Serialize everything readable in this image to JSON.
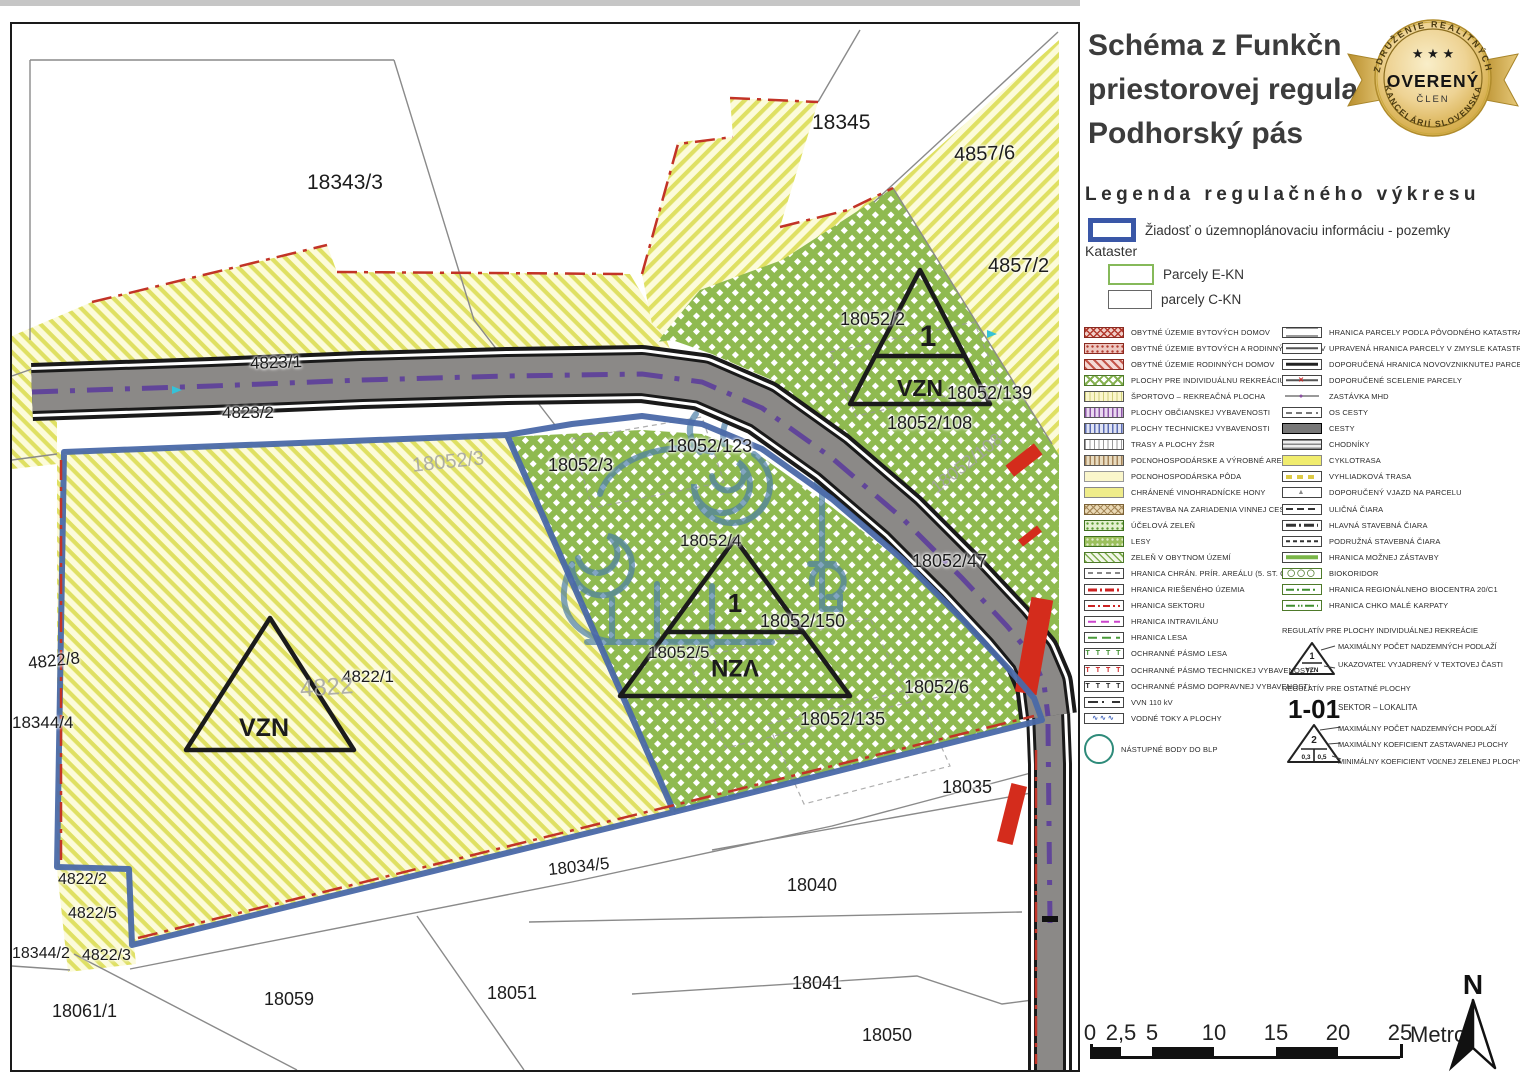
{
  "title": {
    "line1": "Schéma z Funkčn",
    "line2": "priestorovej regula",
    "line3": "Podhorský pás"
  },
  "badge": {
    "arc_top": "ZDRUŽENIE REALITNÝCH",
    "arc_bottom": "KANCELÁRIÍ SLOVENSKA",
    "stars": "★ ★ ★",
    "main": "OVERENÝ",
    "sub": "ČLEN"
  },
  "legend": {
    "heading": "Legenda regulačného výkresu",
    "request": {
      "label": "Žiadosť o územnoplánovaciu informáciu - pozemky"
    },
    "kataster_heading": "Kataster",
    "kataster_items": [
      {
        "label": "Parcely E-KN"
      },
      {
        "label": "parcely C-KN"
      }
    ],
    "left_items": [
      {
        "label": "OBYTNÉ ÚZEMIE BYTOVÝCH DOMOV",
        "sw": "sw-red-cross"
      },
      {
        "label": "OBYTNÉ ÚZEMIE BYTOVÝCH A RODINNÝCH DOMOV",
        "sw": "sw-red-dots"
      },
      {
        "label": "OBYTNÉ ÚZEMIE RODINNÝCH DOMOV",
        "sw": "sw-red-stripes"
      },
      {
        "label": "PLOCHY PRE INDIVIDUÁLNU REKREÁCIU",
        "sw": "sw-green-lat"
      },
      {
        "label": "ŠPORTOVO – REKREAČNÁ PLOCHA",
        "sw": "sw-yel-vert"
      },
      {
        "label": "PLOCHY OBČIANSKEJ VYBAVENOSTI",
        "sw": "sw-pur-vert"
      },
      {
        "label": "PLOCHY TECHNICKEJ VYBAVENOSTI",
        "sw": "sw-blu-vert"
      },
      {
        "label": "TRASY A PLOCHY ŽSR",
        "sw": "sw-gry-vert"
      },
      {
        "label": "POĽNOHOSPODÁRSKE A VÝROBNÉ AREÁLY",
        "sw": "sw-tan-vert"
      },
      {
        "label": "POĽNOHOSPODÁRSKA PÔDA",
        "sw": "sw-pale-yellow"
      },
      {
        "label": "CHRÁNENÉ VINOHRADNÍCKE HONY",
        "sw": "sw-yellow"
      },
      {
        "label": "PRESTAVBA NA ZARIADENIA VINNEJ CESTY",
        "sw": "sw-tan-lat"
      },
      {
        "label": "ÚČELOVÁ ZELEŇ",
        "sw": "sw-green-dots"
      },
      {
        "label": "LESY",
        "sw": "sw-lesy"
      },
      {
        "label": "ZELEŇ V OBYTNOM ÚZEMÍ",
        "sw": "sw-green-diag"
      },
      {
        "label": "HRANICA CHRÁN. PRÍR. AREÁLU (5. ST. OCHR.)",
        "ln": "ln-gryD"
      },
      {
        "label": "HRANICA RIEŠENÉHO ÚZEMIA",
        "ln": "ln-redDD"
      },
      {
        "label": "HRANICA SEKTORU",
        "ln": "ln-redDD2"
      },
      {
        "label": "HRANICA INTRAVILÁNU",
        "ln": "ln-magD"
      },
      {
        "label": "HRANICA LESA",
        "ln": "ln-grnDsh"
      },
      {
        "label": "OCHRANNÉ PÁSMO LESA",
        "glyph": "T T T T",
        "gcls": "g-grn"
      },
      {
        "label": "OCHRANNÉ PÁSMO TECHNICKEJ VYBAVENOSTI",
        "glyph": "T T T T",
        "gcls": "g-red"
      },
      {
        "label": "OCHRANNÉ PÁSMO DOPRAVNEJ VYBAVENOSTI",
        "glyph": "T T T T",
        "gcls": "g-blk"
      },
      {
        "label": "VVN 110 kV",
        "ln": "ln-vvn"
      },
      {
        "label": "VODNÉ TOKY A PLOCHY",
        "glyph": "∿∿∿",
        "gcls": "g-blu"
      },
      {
        "label": "NÁSTUPNÉ BODY DO BLP",
        "sw": "sw-circle",
        "big": true
      }
    ],
    "right_items": [
      {
        "label": "HRANICA PARCELY PODĽA PÔVODNÉHO KATASTRA",
        "ln": "ln-two"
      },
      {
        "label": "UPRAVENÁ HRANICA PARCELY V ZMYSLE KATASTRA",
        "ln": "ln-one"
      },
      {
        "label": "DOPORUČENÁ HRANICA NOVOVZNIKNUTEJ PARCELY",
        "ln": "ln-oneT"
      },
      {
        "label": "DOPORUČENÉ SCELENIE PARCELY",
        "ln": "ln-one",
        "glyph": "✕",
        "gcls": "g-redx"
      },
      {
        "label": "ZASTÁVKA MHD",
        "ln": "ln-gray",
        "glyph": "●",
        "gcls": "g-pur",
        "nb": true
      },
      {
        "label": "OS CESTY",
        "ln": "ln-osc"
      },
      {
        "label": "CESTY",
        "sw": "sw-dark"
      },
      {
        "label": "CHODNÍKY",
        "sw": "sw-hstripes"
      },
      {
        "label": "CYKLOTRASA",
        "sw": "sw-cyk"
      },
      {
        "label": "VYHLIADKOVÁ TRASA",
        "ln": "ln-yelD"
      },
      {
        "label": "DOPORUČENÝ VJAZD NA PARCELU",
        "glyph": "▲",
        "gcls": "g-gryT"
      },
      {
        "label": "ULIČNÁ ČIARA",
        "ln": "ln-ulc"
      },
      {
        "label": "HLAVNÁ STAVEBNÁ ČIARA",
        "ln": "ln-hlv"
      },
      {
        "label": "PODRUŽNÁ STAVEBNÁ ČIARA",
        "ln": "ln-pdr"
      },
      {
        "label": "HRANICA MOŽNEJ ZÁSTAVBY",
        "ln": "ln-grn"
      },
      {
        "label": "BIOKORIDOR",
        "glyph": "◯◯◯",
        "gcls": "g-grnO",
        "grn": true
      },
      {
        "label": "HRANICA REGIONÁLNEHO BIOCENTRA 20/C1",
        "ln": "ln-bioc",
        "grn": true
      },
      {
        "label": "HRANICA CHKO MALÉ KARPATY",
        "ln": "ln-chko",
        "grn": true
      }
    ],
    "section1": {
      "heading": "REGULATÍV PRE PLOCHY INDIVIDUÁLNEJ REKREÁCIE",
      "tri_top": "1",
      "tri_bottom": "VZN",
      "notes": [
        "MAXIMÁLNY POČET NADZEMNÝCH PODLAŽÍ",
        "UKAZOVATEĽ VYJADRENÝ V TEXTOVEJ ČASTI"
      ]
    },
    "section2": {
      "heading": "REGULATÍV PRE OSTATNÉ PLOCHY",
      "sector_code": "1-01",
      "sector_label": "SEKTOR – LOKALITA",
      "tri_top": "2",
      "tri_bl": "0,3",
      "tri_br": "0,5",
      "notes": [
        "MAXIMÁLNY POČET NADZEMNÝCH PODLAŽÍ",
        "MAXIMÁLNY KOEFICIENT ZASTAVANEJ PLOCHY",
        "MINIMÁLNY KOEFICIENT VOĽNEJ ZELENEJ PLOCHY"
      ]
    }
  },
  "map": {
    "vzn1": {
      "top": "1",
      "bottom": "VZN"
    },
    "vzn2": {
      "top": "1",
      "bottom": "VZN"
    },
    "vzn3": {
      "bottom": "VZN"
    },
    "labels": [
      {
        "t": "18343/3",
        "x": 295,
        "y": 148,
        "s": 21
      },
      {
        "t": "18345",
        "x": 800,
        "y": 88,
        "s": 21
      },
      {
        "t": "4857/6",
        "x": 942,
        "y": 120,
        "s": 20,
        "r": -2
      },
      {
        "t": "4857/2",
        "x": 976,
        "y": 232,
        "s": 20
      },
      {
        "t": "18052/2",
        "x": 828,
        "y": 286,
        "s": 18
      },
      {
        "t": "18052/139",
        "x": 935,
        "y": 360,
        "s": 18
      },
      {
        "t": "18052/108",
        "x": 875,
        "y": 390,
        "s": 18
      },
      {
        "t": "4823/1",
        "x": 238,
        "y": 330,
        "s": 17,
        "r": -2
      },
      {
        "t": "4823/2",
        "x": 210,
        "y": 380,
        "s": 17
      },
      {
        "t": "18052/123",
        "x": 655,
        "y": 413,
        "s": 18
      },
      {
        "t": "18052/3",
        "x": 536,
        "y": 432,
        "s": 18
      },
      {
        "t": "18052/4",
        "x": 668,
        "y": 508,
        "s": 17
      },
      {
        "t": "18052/47",
        "x": 900,
        "y": 528,
        "s": 18
      },
      {
        "t": "18052/150",
        "x": 748,
        "y": 588,
        "s": 18
      },
      {
        "t": "18052/5",
        "x": 636,
        "y": 620,
        "s": 17
      },
      {
        "t": "18052/6",
        "x": 892,
        "y": 654,
        "s": 18
      },
      {
        "t": "18052/135",
        "x": 788,
        "y": 686,
        "s": 18
      },
      {
        "t": "4822/8",
        "x": 16,
        "y": 628,
        "s": 17,
        "r": -6
      },
      {
        "t": "18344/4",
        "x": 0,
        "y": 690,
        "s": 17
      },
      {
        "t": "4822/1",
        "x": 330,
        "y": 644,
        "s": 17
      },
      {
        "t": "4822/2",
        "x": 46,
        "y": 848,
        "s": 16
      },
      {
        "t": "4822/5",
        "x": 56,
        "y": 882,
        "s": 16
      },
      {
        "t": "18344/2",
        "x": 0,
        "y": 922,
        "s": 16
      },
      {
        "t": "4822/3",
        "x": 70,
        "y": 924,
        "s": 16
      },
      {
        "t": "18061/1",
        "x": 40,
        "y": 978,
        "s": 18
      },
      {
        "t": "18059",
        "x": 252,
        "y": 966,
        "s": 18
      },
      {
        "t": "18051",
        "x": 475,
        "y": 960,
        "s": 18
      },
      {
        "t": "18034/5",
        "x": 536,
        "y": 834,
        "s": 17,
        "r": -6
      },
      {
        "t": "18040",
        "x": 775,
        "y": 852,
        "s": 18
      },
      {
        "t": "18035",
        "x": 930,
        "y": 754,
        "s": 18
      },
      {
        "t": "18041",
        "x": 780,
        "y": 950,
        "s": 18
      },
      {
        "t": "18050",
        "x": 850,
        "y": 1002,
        "s": 18
      }
    ],
    "watermark_labels": [
      {
        "t": "4822",
        "x": 288,
        "y": 652,
        "s": 24,
        "r": -4
      },
      {
        "t": "18052/3",
        "x": 400,
        "y": 428,
        "s": 20,
        "r": -6
      },
      {
        "t": "18052/108",
        "x": 912,
        "y": 430,
        "s": 18,
        "r": -38
      }
    ]
  },
  "scalebar": {
    "ticks": [
      {
        "label": "0",
        "dx": 0
      },
      {
        "label": "2,5",
        "dx": 31
      },
      {
        "label": "5",
        "dx": 62
      },
      {
        "label": "10",
        "dx": 124
      },
      {
        "label": "15",
        "dx": 186
      },
      {
        "label": "20",
        "dx": 248
      },
      {
        "label": "25",
        "dx": 310
      }
    ],
    "filled": [
      [
        0,
        31
      ],
      [
        62,
        124
      ],
      [
        186,
        248
      ]
    ],
    "total": 310,
    "unit": "Metrov"
  },
  "north": {
    "label": "N"
  },
  "colors": {
    "boundary_blue": "#4a69a8",
    "area_yellow": "#fcfbda",
    "area_green": "#8fba50",
    "road_gray": "#8b8987",
    "accent_red": "#c23327",
    "cyclo_purple": "#5c3e9b",
    "badge_gold": "#d4a93c"
  }
}
